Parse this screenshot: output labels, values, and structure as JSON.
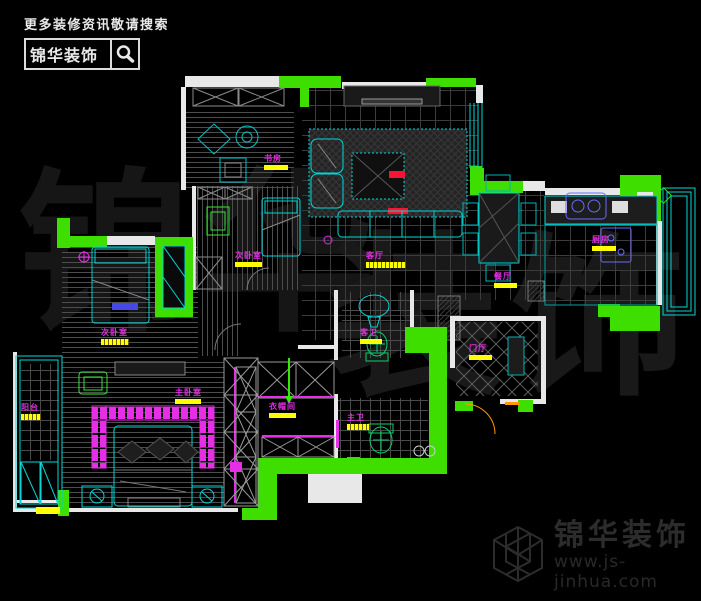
{
  "header_watermark": {
    "tagline": "更多装修资讯敬请搜索",
    "brand": "锦华装饰",
    "search_icon": "magnifier-icon"
  },
  "footer_logo": {
    "brand": "锦华装饰",
    "url": "www.js-jinhua.com",
    "logo_icon": "cube-wireframe-icon"
  },
  "background_watermark": {
    "part1": "锦华",
    "part2": "装饰"
  },
  "floor_plan": {
    "type": "apartment-floor-plan",
    "rooms": [
      {
        "name": "study",
        "label": "书房"
      },
      {
        "name": "bedroom-2",
        "label": "次卧室"
      },
      {
        "name": "living-room",
        "label": "客厅"
      },
      {
        "name": "dining-room",
        "label": "餐厅"
      },
      {
        "name": "kitchen",
        "label": "厨房"
      },
      {
        "name": "foyer",
        "label": "门厅"
      },
      {
        "name": "walk-in-closet",
        "label": "衣帽间"
      },
      {
        "name": "master-bedroom",
        "label": "主卧室"
      },
      {
        "name": "bedroom-3",
        "label": "次卧室"
      },
      {
        "name": "balcony",
        "label": "阳台"
      },
      {
        "name": "guest-bathroom",
        "label": "客卫"
      },
      {
        "name": "master-bathroom",
        "label": "主卫"
      }
    ],
    "colors": {
      "walls": "#e8e8e8",
      "highlight_green": "#3ede00",
      "furniture_cyan": "#00d7d7",
      "label_magenta": "#e62ee6",
      "label_bar_yellow": "#ffff00",
      "accent_blue": "#5b5bff",
      "accent_red": "#ff1133",
      "accent_orange": "#ff9900",
      "background": "#000000"
    }
  }
}
